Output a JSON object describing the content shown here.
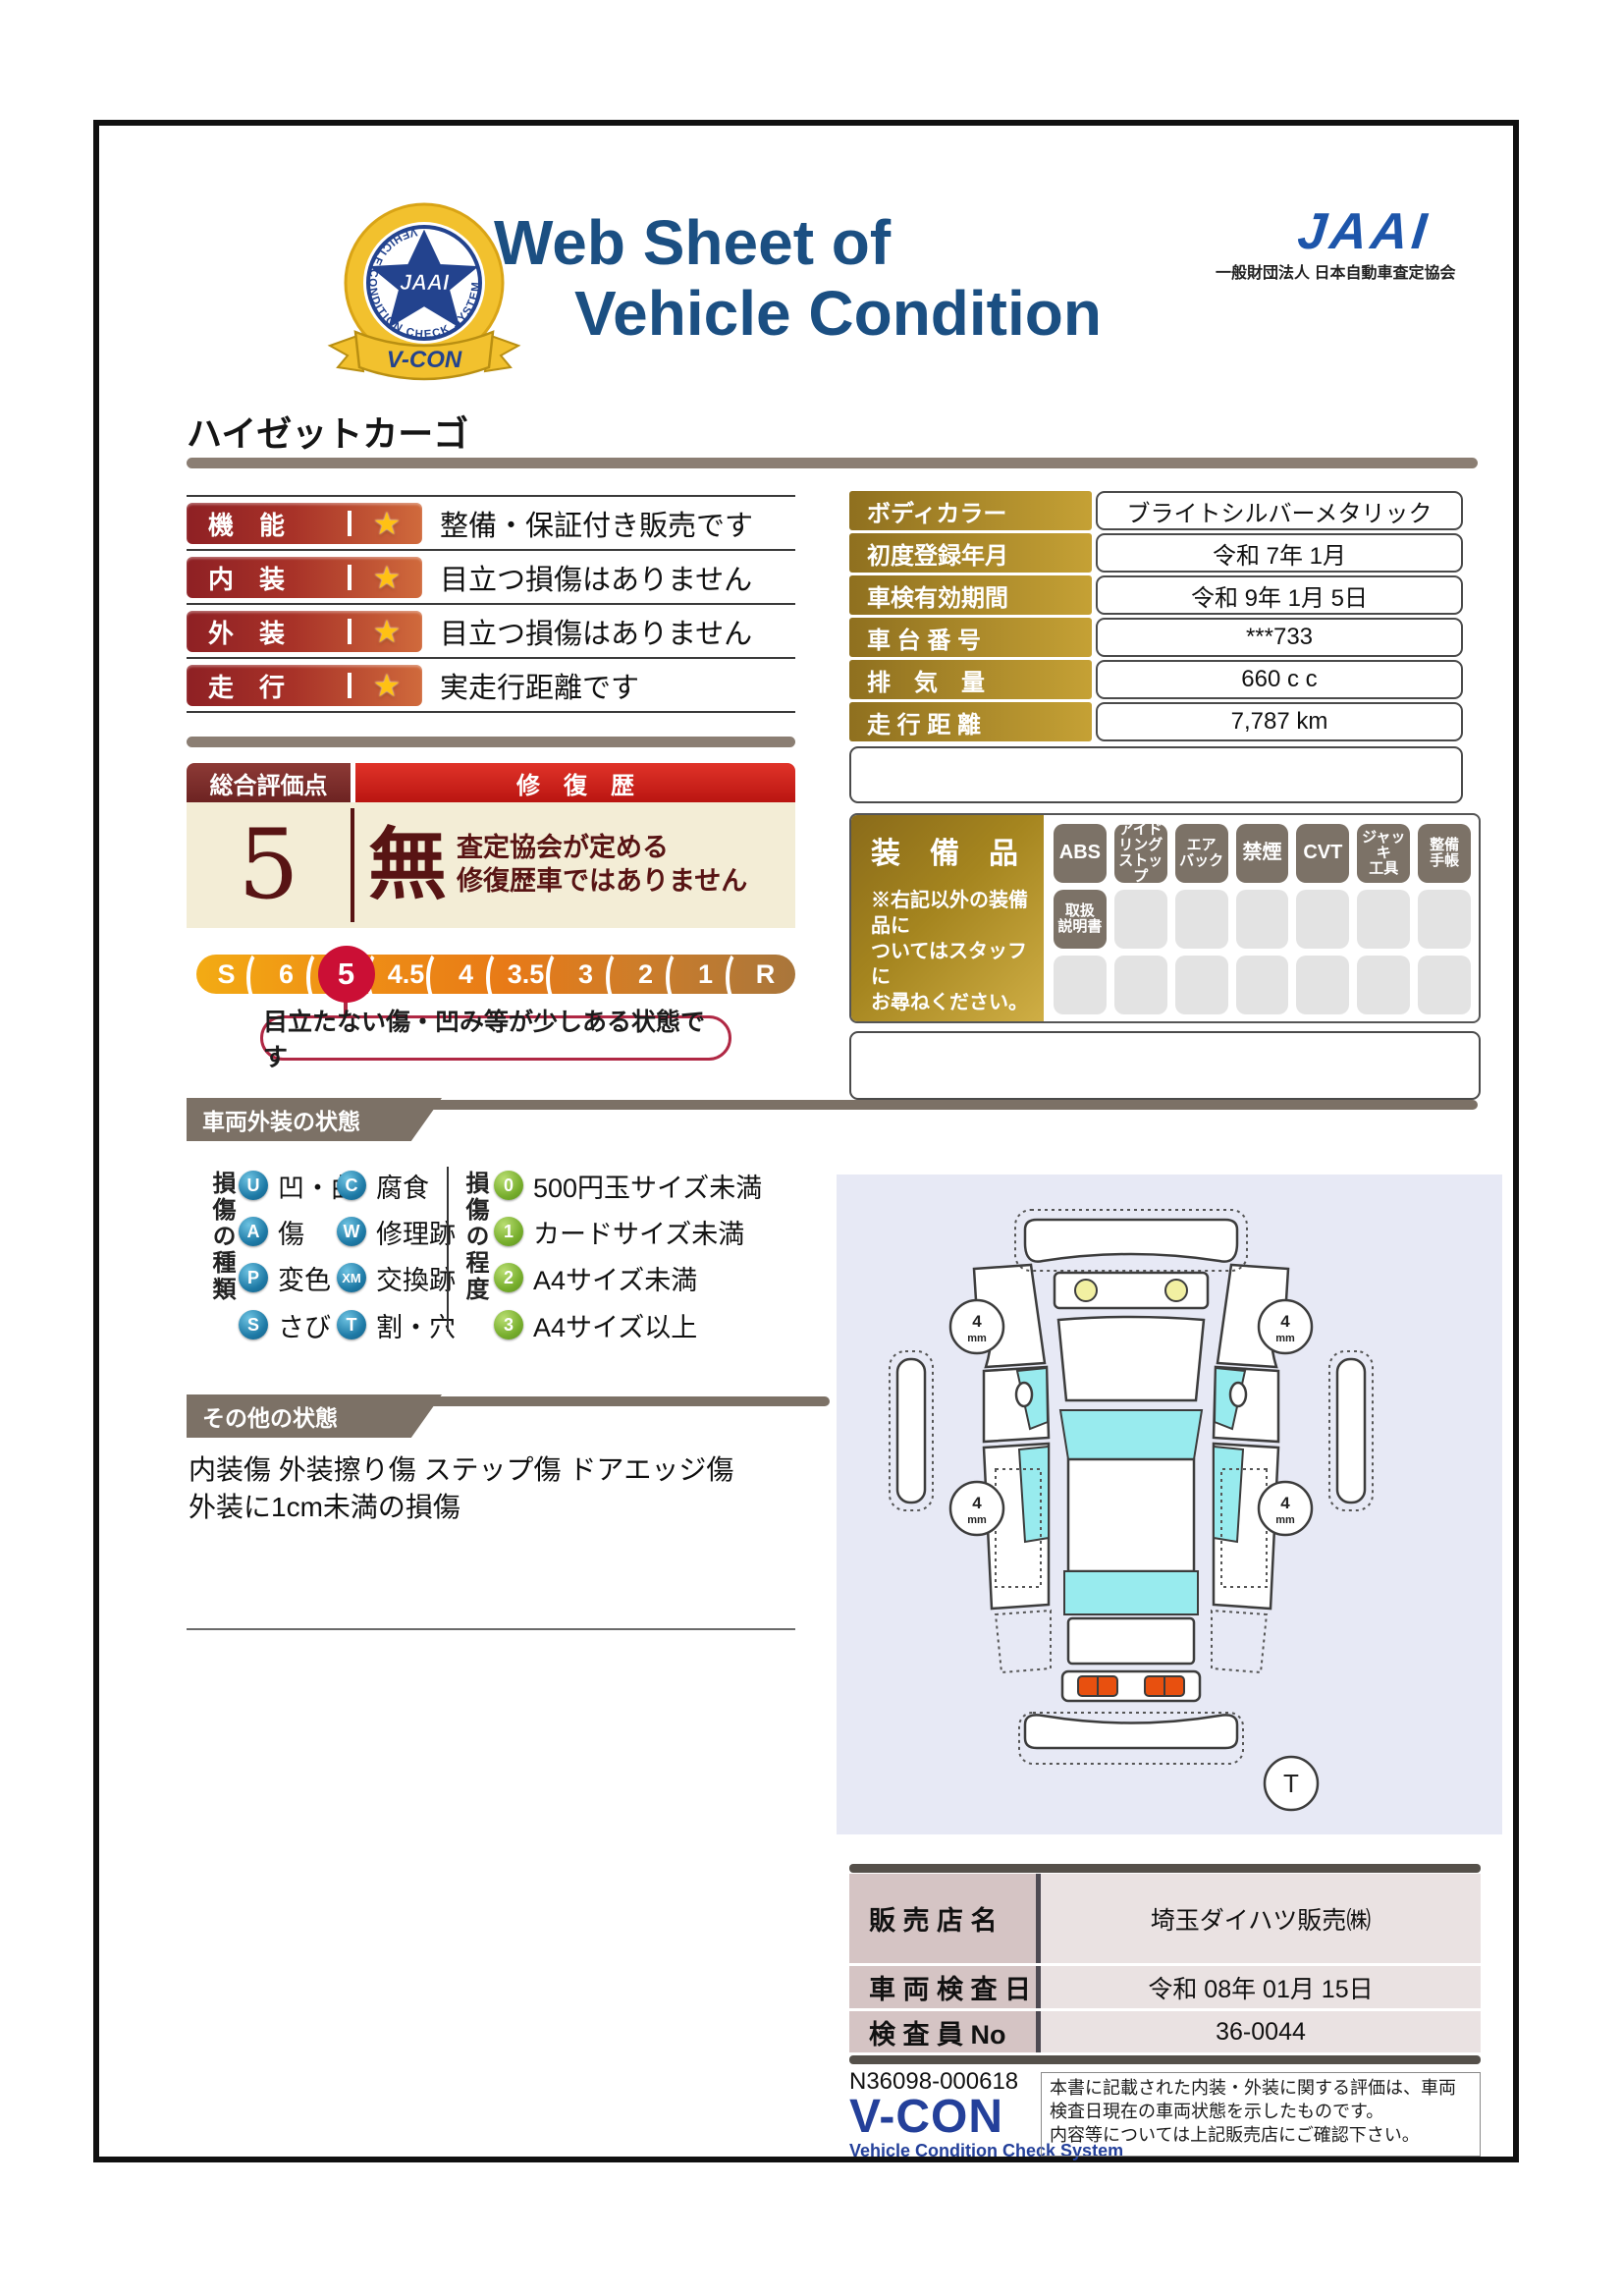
{
  "colors": {
    "title_blue": "#1b4f82",
    "jaai_blue": "#1d55aa",
    "band_taupe": "#7c7166",
    "rating_red": "#8e2024",
    "star_gold": "#ffc114",
    "score_cream": "#f3edd6",
    "score_maroon": "#581414",
    "selected_crimson": "#cb0f35",
    "gold_label": "#c5a135",
    "badge_gray": "#7c7267",
    "type_circle_blue": "#1e7aa6",
    "grade_circle_green": "#76ad2c",
    "diagram_lavender": "#e7e9f5",
    "dealer_label_pink": "#d5c4c4",
    "vcon_blue": "#24409a"
  },
  "header": {
    "badge_banner": "V-CON",
    "badge_ring_text": "VEHICLE CONDITION CHECK SYSTEM",
    "badge_star_text": "JAAI",
    "title_line1": "Web Sheet of",
    "title_line2": "Vehicle Condition",
    "jaai_wordmark": "JAAI",
    "jaai_subtitle": "一般財団法人 日本自動車査定協会"
  },
  "vehicle_name": "ハイゼットカーゴ",
  "ratings": [
    {
      "label": "機　能",
      "star": "★",
      "description": "整備・保証付き販売です"
    },
    {
      "label": "内　装",
      "star": "★",
      "description": "目立つ損傷はありません"
    },
    {
      "label": "外　装",
      "star": "★",
      "description": "目立つ損傷はありません"
    },
    {
      "label": "走　行",
      "star": "★",
      "description": "実走行距離です"
    }
  ],
  "score": {
    "header_left": "総合評価点",
    "header_right": "修　復　歴",
    "value": "5",
    "repair": "無",
    "repair_note_line1": "査定協会が定める",
    "repair_note_line2": "修復歴車ではありません",
    "scale": [
      "S",
      "6",
      "5",
      "4.5",
      "4",
      "3.5",
      "3",
      "2",
      "1",
      "R"
    ],
    "selected": "5",
    "note": "目立たない傷・凹み等が少しある状態です"
  },
  "info_table": {
    "rows": [
      {
        "label": "ボディカラー",
        "value": "ブライトシルバーメタリック"
      },
      {
        "label": "初度登録年月",
        "value": "令和 7年 1月"
      },
      {
        "label": "車検有効期間",
        "value": "令和 9年 1月 5日"
      },
      {
        "label": "車 台 番 号",
        "value": "***733"
      },
      {
        "label": "排　気　量",
        "value": "660 c c"
      },
      {
        "label": "走 行 距 離",
        "value": "7,787 km"
      }
    ]
  },
  "equipment": {
    "title": "装　備　品",
    "note": "※右記以外の装備品に\nついてはスタッフに\nお尋ねください。",
    "badges": [
      "ABS",
      "アイド\nリング\nストップ",
      "エア\nバック",
      "禁煙",
      "CVT",
      "ジャッキ\n工具",
      "整備\n手帳",
      "取扱\n説明書"
    ]
  },
  "exterior": {
    "section_title": "車両外装の状態",
    "types_title": "損傷の種類",
    "types": [
      {
        "code": "U",
        "label": "凹・曲"
      },
      {
        "code": "C",
        "label": "腐食"
      },
      {
        "code": "A",
        "label": "傷"
      },
      {
        "code": "W",
        "label": "修理跡"
      },
      {
        "code": "P",
        "label": "変色"
      },
      {
        "code": "XM",
        "label": "交換跡"
      },
      {
        "code": "S",
        "label": "さび"
      },
      {
        "code": "T",
        "label": "割・穴"
      }
    ],
    "grades_title": "損傷の程度",
    "grades": [
      {
        "code": "0",
        "label": "500円玉サイズ未満"
      },
      {
        "code": "1",
        "label": "カードサイズ未満"
      },
      {
        "code": "2",
        "label": "A4サイズ未満"
      },
      {
        "code": "3",
        "label": "A4サイズ以上"
      }
    ]
  },
  "other": {
    "section_title": "その他の状態",
    "text": "内装傷 外装擦り傷 ステップ傷 ドアエッジ傷\n外装に1cm未満の損傷"
  },
  "diagram": {
    "tread_value": "4",
    "tread_unit": "mm",
    "marker": "T"
  },
  "dealer": {
    "rows": [
      {
        "label": "販 売 店 名",
        "value": "埼玉ダイハツ販売㈱"
      },
      {
        "label": "車 両 検 査 日",
        "value": "令和 08年 01月 15日"
      },
      {
        "label": "検 査 員 No",
        "value": "36-0044"
      }
    ]
  },
  "footer": {
    "doc_number": "N36098-000618",
    "vcon": "V-CON",
    "vcon_sub": "Vehicle Condition Check System",
    "disclaimer": "本書に記載された内装・外装に関する評価は、車両\n検査日現在の車両状態を示したものです。\n内容等については上記販売店にご確認下さい。"
  }
}
